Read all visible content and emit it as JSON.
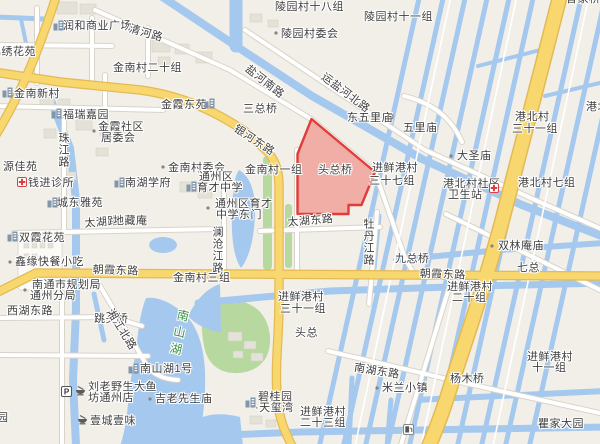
{
  "map": {
    "colors": {
      "background": "#f2efe9",
      "water": "#a5c8ef",
      "road_yellow": "#f8d76e",
      "road_yellow_casing": "#e3ba55",
      "road_white_casing": "#d8d4c8",
      "building": "#e4e1d7",
      "park_green": "#b7d99f",
      "highlight_fill": "#ef9e96",
      "highlight_border": "#e23c39",
      "label_text": "#3f3f3f",
      "scenic_label_green": "#3c8e43"
    },
    "highlight": {
      "label": "头总桥"
    },
    "labels": [
      {
        "name": "label-runhe-plaza",
        "text": "润和商业广场",
        "x": 63,
        "y": 20
      },
      {
        "name": "label-qinghe-road",
        "text": "清河路",
        "x": 131,
        "y": 23,
        "rot": 16
      },
      {
        "name": "label-lingyuan-18",
        "text": "陵园村十八组",
        "x": 275,
        "y": 1
      },
      {
        "name": "label-lingyuan-11",
        "text": "陵园村十一组",
        "x": 364,
        "y": 11
      },
      {
        "name": "label-jinxiu-huayuan",
        "text": "锦绣花苑",
        "x": -10,
        "y": 46
      },
      {
        "name": "label-jinnan-20",
        "text": "金南村二十组",
        "x": 113,
        "y": 62
      },
      {
        "name": "label-lingyuan-committee",
        "text": "陵园村委会",
        "x": 281,
        "y": 28
      },
      {
        "name": "label-jinnan-xincun",
        "text": "金南新村",
        "x": 14,
        "y": 88
      },
      {
        "name": "label-yanhenan-road",
        "text": "盐河南路",
        "x": 250,
        "y": 63,
        "rot": 38
      },
      {
        "name": "label-furui-jiayuan",
        "text": "福瑞嘉园",
        "x": 63,
        "y": 109
      },
      {
        "name": "label-jinxia-dongyuan",
        "text": "金霞东苑",
        "x": 161,
        "y": 99
      },
      {
        "name": "label-sanzong-bridge",
        "text": "三总桥",
        "x": 243,
        "y": 103
      },
      {
        "name": "label-yunyanhebei-road",
        "text": "运盐河北路",
        "x": 326,
        "y": 71,
        "rot": 37
      },
      {
        "name": "label-dongwuli-temple",
        "text": "东五里庙",
        "x": 347,
        "y": 112
      },
      {
        "name": "label-wuli-temple",
        "text": "五里庙",
        "x": 403,
        "y": 122
      },
      {
        "name": "label-gangbei-village",
        "text": "港北村",
        "x": 515,
        "y": 111
      },
      {
        "name": "label-gangbei-31",
        "text": "三十一组",
        "x": 512,
        "y": 123
      },
      {
        "name": "label-jinxia-community-1",
        "text": "金霞社区",
        "x": 98,
        "y": 121
      },
      {
        "name": "label-jinxia-community-2",
        "text": "居委会",
        "x": 101,
        "y": 132
      },
      {
        "name": "label-zhujiang-road",
        "text": "珠江路",
        "x": 57,
        "y": 132,
        "v": true
      },
      {
        "name": "label-yuanjia-yuan",
        "text": "源佳苑",
        "x": 3,
        "y": 161
      },
      {
        "name": "label-jinnan-committee",
        "text": "金南村委会",
        "x": 168,
        "y": 162
      },
      {
        "name": "label-jinnan-1",
        "text": "金南村一组",
        "x": 245,
        "y": 164
      },
      {
        "name": "label-yinhe-road",
        "text": "银河东路",
        "x": 238,
        "y": 123,
        "rot": 33
      },
      {
        "name": "label-jinxian-37-1",
        "text": "进鲜港村",
        "x": 372,
        "y": 162
      },
      {
        "name": "label-jinxian-37-2",
        "text": "三十七组",
        "x": 369,
        "y": 175
      },
      {
        "name": "label-gangbei-7",
        "text": "港北村七组",
        "x": 518,
        "y": 177
      },
      {
        "name": "label-dasheng-temple",
        "text": "大圣庙",
        "x": 457,
        "y": 150
      },
      {
        "name": "label-gangbei-clinic-1",
        "text": "港北村社区",
        "x": 443,
        "y": 178
      },
      {
        "name": "label-gangbei-clinic-2",
        "text": "卫生站",
        "x": 448,
        "y": 189
      },
      {
        "name": "label-gangbei-edge",
        "text": "港北村",
        "x": 586,
        "y": 101
      },
      {
        "name": "label-qianjin-clinic",
        "text": "钱进诊所",
        "x": 28,
        "y": 177
      },
      {
        "name": "label-nanhu-xuefu",
        "text": "南湖学府",
        "x": 125,
        "y": 177
      },
      {
        "name": "label-yucai-school-1",
        "text": "通州区",
        "x": 199,
        "y": 171
      },
      {
        "name": "label-yucai-school-2",
        "text": "育才中学",
        "x": 197,
        "y": 182
      },
      {
        "name": "label-chengdong-yayuan",
        "text": "城东雅苑",
        "x": 57,
        "y": 197
      },
      {
        "name": "label-yucai-eastgate-1",
        "text": "通州区育才",
        "x": 215,
        "y": 198
      },
      {
        "name": "label-yucai-eastgate-2",
        "text": "中学东门",
        "x": 216,
        "y": 209
      },
      {
        "name": "label-touzong-bridge",
        "text": "头总桥",
        "x": 318,
        "y": 164
      },
      {
        "name": "label-taihu-road",
        "text": "太湖路",
        "x": 84,
        "y": 218,
        "rot": -5
      },
      {
        "name": "label-dizang-temple",
        "text": "地藏庵",
        "x": 113,
        "y": 215
      },
      {
        "name": "label-lancangjiang-road",
        "text": "澜沧江路",
        "x": 211,
        "y": 226,
        "v": true
      },
      {
        "name": "label-taihu-east-road",
        "text": "太湖东路",
        "x": 287,
        "y": 217,
        "rot": -5
      },
      {
        "name": "label-shuangxia-huayuan",
        "text": "双霞花苑",
        "x": 19,
        "y": 232
      },
      {
        "name": "label-mudanjiang-road",
        "text": "牡丹江路",
        "x": 362,
        "y": 218,
        "v": true
      },
      {
        "name": "label-shuanglin-temple",
        "text": "双林庵庙",
        "x": 498,
        "y": 240
      },
      {
        "name": "label-jiuzong-bridge",
        "text": "九总桥",
        "x": 395,
        "y": 253
      },
      {
        "name": "label-qizong",
        "text": "七总",
        "x": 517,
        "y": 262
      },
      {
        "name": "label-xinyuan-snack",
        "text": "鑫缘快餐小吃",
        "x": 15,
        "y": 256
      },
      {
        "name": "label-zhaoxia-road-west",
        "text": "朝霞东路",
        "x": 93,
        "y": 264,
        "rot": 2
      },
      {
        "name": "label-zhaoxia-road-east",
        "text": "朝霞东路",
        "x": 420,
        "y": 268,
        "rot": 2
      },
      {
        "name": "label-planning-bureau-1",
        "text": "南通市规划局",
        "x": 32,
        "y": 279
      },
      {
        "name": "label-planning-bureau-2",
        "text": "通州分局",
        "x": 30,
        "y": 290
      },
      {
        "name": "label-jinnan-3",
        "text": "金南村三组",
        "x": 173,
        "y": 272
      },
      {
        "name": "label-jinxian-31-1",
        "text": "进鲜港村",
        "x": 278,
        "y": 291
      },
      {
        "name": "label-jinxian-31-2",
        "text": "三十一组",
        "x": 280,
        "y": 303
      },
      {
        "name": "label-jinxian-20-1",
        "text": "进鲜港村",
        "x": 447,
        "y": 281
      },
      {
        "name": "label-jinxian-20-2",
        "text": "二十组",
        "x": 452,
        "y": 292
      },
      {
        "name": "label-xihu-road",
        "text": "西湖东路",
        "x": 7,
        "y": 305
      },
      {
        "name": "label-tiaotou-bridge",
        "text": "跳头桥",
        "x": 94,
        "y": 313
      },
      {
        "name": "label-xiangjiang-road",
        "text": "湘江北路",
        "x": 114,
        "y": 307,
        "rot": 58
      },
      {
        "name": "label-touzong",
        "text": "头总",
        "x": 295,
        "y": 327
      },
      {
        "name": "label-nanshan-lake",
        "text": "南山湖",
        "x": 178,
        "y": 308,
        "v": true,
        "cls": "scenic",
        "rot": 12
      },
      {
        "name": "label-nanhu-east-road",
        "text": "南湖东路",
        "x": 355,
        "y": 362,
        "rot": 9
      },
      {
        "name": "label-milan-town",
        "text": "米兰小镇",
        "x": 382,
        "y": 382
      },
      {
        "name": "label-yangmu-bridge",
        "text": "杨木桥",
        "x": 450,
        "y": 373
      },
      {
        "name": "label-jinxian-11-1",
        "text": "进鲜港村",
        "x": 527,
        "y": 351
      },
      {
        "name": "label-jinxian-11-2",
        "text": "十一组",
        "x": 532,
        "y": 362
      },
      {
        "name": "label-nanshanhu-no1",
        "text": "南山湖1号",
        "x": 140,
        "y": 363
      },
      {
        "name": "label-liulao-fish-1",
        "text": "刘老野生大鱼",
        "x": 88,
        "y": 381
      },
      {
        "name": "label-liulao-fish-2",
        "text": "坊通州店",
        "x": 88,
        "y": 392
      },
      {
        "name": "label-jilao-temple",
        "text": "吉老先生庙",
        "x": 155,
        "y": 393
      },
      {
        "name": "label-biguiyuan-1",
        "text": "碧桂园",
        "x": 258,
        "y": 391
      },
      {
        "name": "label-biguiyuan-2",
        "text": "·天玺湾",
        "x": 255,
        "y": 402
      },
      {
        "name": "label-yicheng-yiwei",
        "text": "壹城壹味",
        "x": 90,
        "y": 415
      },
      {
        "name": "label-jinxian-23-1",
        "text": "进鲜港村",
        "x": 300,
        "y": 406
      },
      {
        "name": "label-jinxian-23-2",
        "text": "二十三组",
        "x": 300,
        "y": 417
      },
      {
        "name": "label-qujia-dayuan",
        "text": "瞿家大园",
        "x": 538,
        "y": 418
      },
      {
        "name": "label-yuan-partial",
        "text": "园",
        "x": -3,
        "y": 412
      },
      {
        "name": "label-caojiaqiao-partial",
        "text": "曹家桥",
        "x": 566,
        "y": -7
      }
    ],
    "icons": [
      {
        "type": "residential-icon",
        "x": 53,
        "y": 20
      },
      {
        "type": "residential-icon",
        "x": 2,
        "y": 87
      },
      {
        "type": "residential-icon",
        "x": 51,
        "y": 108
      },
      {
        "type": "residential-icon",
        "x": 204,
        "y": 98
      },
      {
        "type": "clinic-cross-icon",
        "x": 17,
        "y": 177
      },
      {
        "type": "residential-icon",
        "x": 114,
        "y": 177
      },
      {
        "type": "residential-icon",
        "x": 186,
        "y": 181
      },
      {
        "type": "residential-icon",
        "x": 47,
        "y": 197
      },
      {
        "type": "residential-icon",
        "x": 7,
        "y": 231
      },
      {
        "type": "clinic-cross-icon",
        "x": 489,
        "y": 183
      },
      {
        "type": "residential-icon",
        "x": 128,
        "y": 363
      },
      {
        "type": "residential-icon",
        "x": 245,
        "y": 397
      },
      {
        "type": "parking-icon",
        "x": 61,
        "y": 386
      },
      {
        "type": "food-icon",
        "x": 75,
        "y": 386
      },
      {
        "type": "food-icon",
        "x": 77,
        "y": 415
      },
      {
        "type": "fuel-icon",
        "x": 403,
        "y": 424
      },
      {
        "type": "temple-ring-icon",
        "x": 387,
        "y": 113
      },
      {
        "type": "poi-dot-icon",
        "x": 274,
        "y": 31
      },
      {
        "type": "poi-dot-icon",
        "x": 161,
        "y": 165
      },
      {
        "type": "poi-dot-icon",
        "x": 92,
        "y": 129
      },
      {
        "type": "poi-dot-icon",
        "x": 206,
        "y": 206
      },
      {
        "type": "poi-dot-icon",
        "x": 449,
        "y": 154
      },
      {
        "type": "poi-dot-icon",
        "x": 490,
        "y": 244
      },
      {
        "type": "poi-dot-icon",
        "x": 375,
        "y": 386
      },
      {
        "type": "poi-dot-icon",
        "x": 8,
        "y": 260
      },
      {
        "type": "poi-dot-icon",
        "x": 23,
        "y": 288
      },
      {
        "type": "poi-dot-icon",
        "x": 148,
        "y": 397
      }
    ]
  }
}
